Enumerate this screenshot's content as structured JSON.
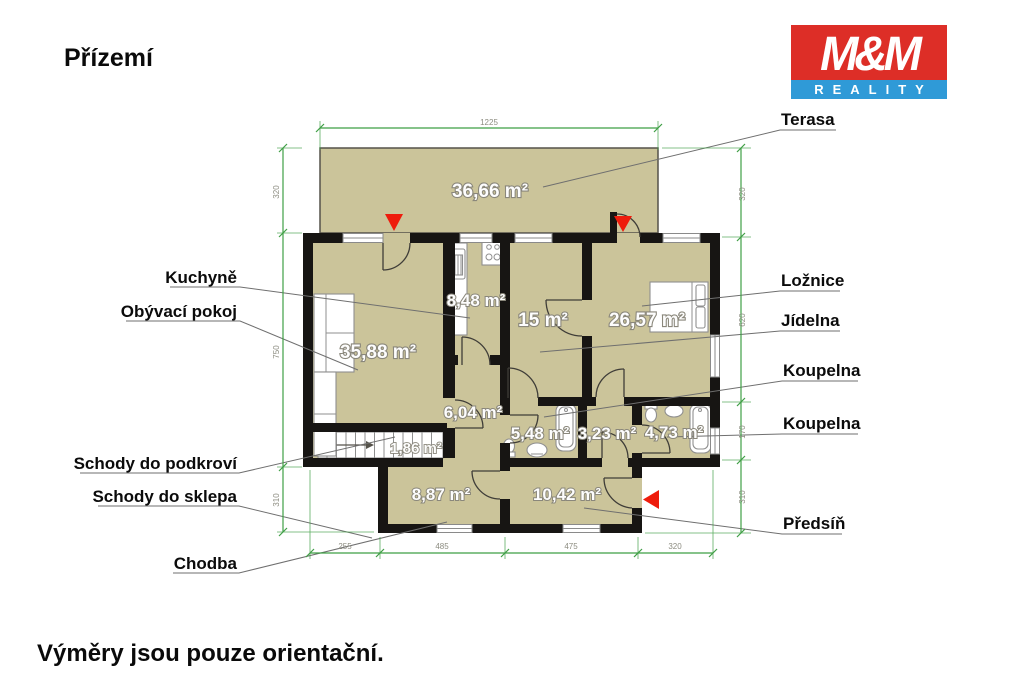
{
  "title": "Přízemí",
  "disclaimer": "Výměry jsou pouze orientační.",
  "logo": {
    "mm": "M&M",
    "reality": "REALITY"
  },
  "rooms": {
    "terasa": {
      "label": "Terasa",
      "area": "36,66 m²"
    },
    "obyvaci_pokoj": {
      "label": "Obývací pokoj",
      "area": "35,88 m²"
    },
    "kuchyne": {
      "label": "Kuchyně",
      "area": "8,48 m²"
    },
    "jidelna": {
      "label": "Jídelna",
      "area": "15 m²"
    },
    "loznice": {
      "label": "Ložnice",
      "area": "26,57 m²"
    },
    "hala": {
      "area": "6,04 m²"
    },
    "schody_podkrovi": {
      "label": "Schody do podkroví",
      "area": "1,86 m²"
    },
    "schody_sklep": {
      "label": "Schody do sklepa"
    },
    "koupelna_1": {
      "label": "Koupelna",
      "area": "5,48 m²"
    },
    "wc": {
      "area": "3,23 m²"
    },
    "koupelna_2": {
      "label": "Koupelna",
      "area": "4,73 m²"
    },
    "chodba": {
      "label": "Chodba",
      "area": "8,87 m²"
    },
    "predsin": {
      "label": "Předsíň",
      "area": "10,42 m²"
    }
  },
  "dimensions": {
    "top": "1225",
    "left": [
      "320",
      "750",
      "310"
    ],
    "right": [
      "320",
      "620",
      "170",
      "310"
    ],
    "bottom": [
      "255",
      "485",
      "475",
      "320"
    ]
  },
  "colors": {
    "room_fill": "#cbc49a",
    "wall": "#171513",
    "dimension_green": "#3f9f45",
    "arrow_red": "#ee1c0c",
    "logo_red": "#dd2e27",
    "logo_blue": "#2f9ad7"
  }
}
